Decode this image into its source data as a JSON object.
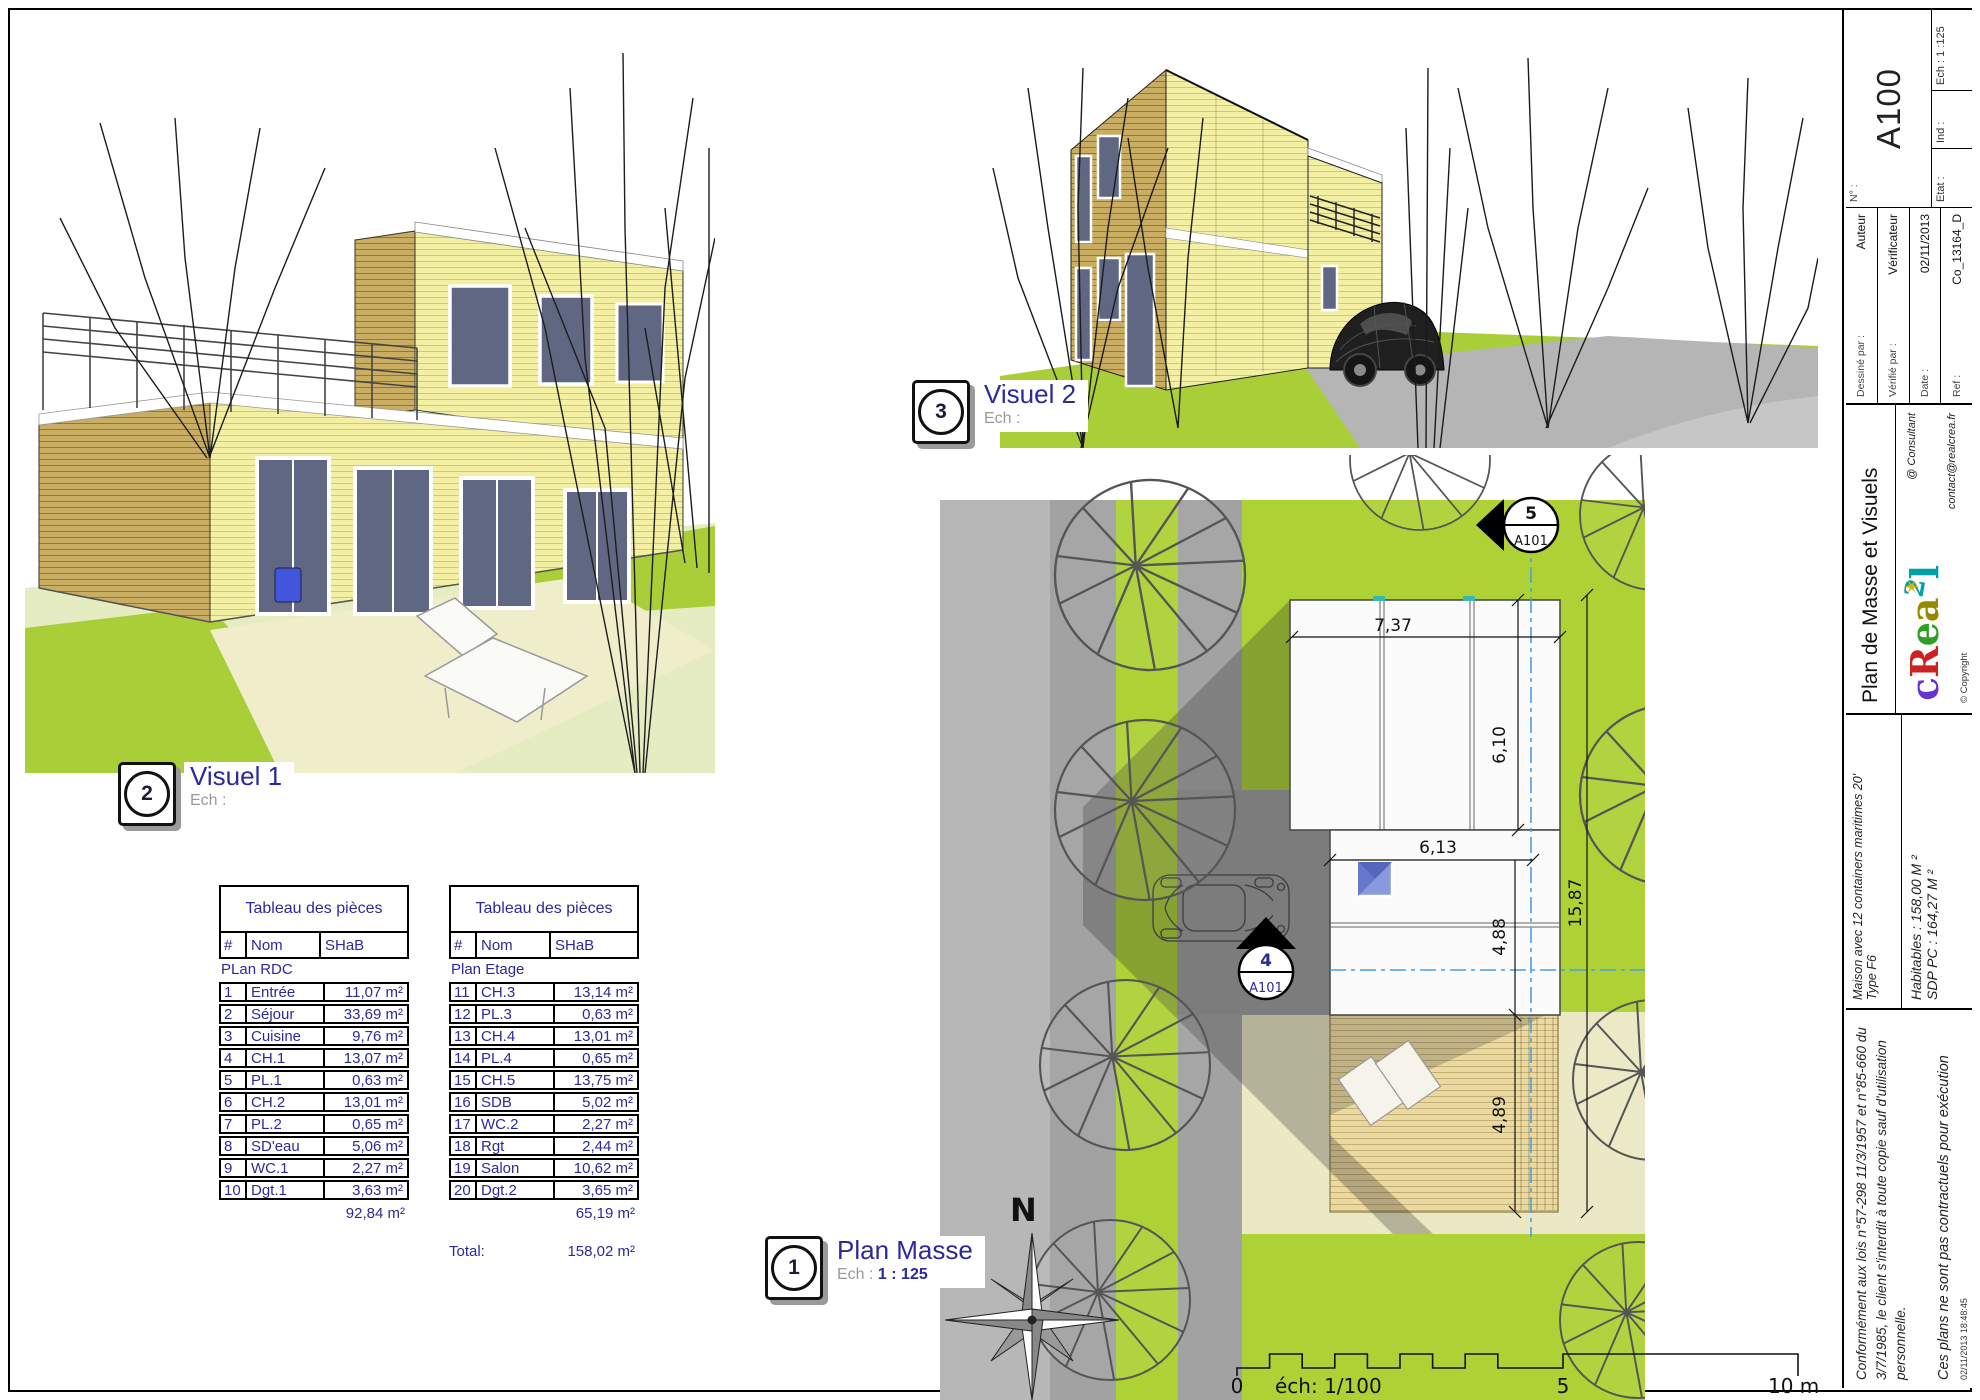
{
  "colors": {
    "lime": "#aed136",
    "navy": "#2a2a9a",
    "siding_tan": "#c8ad62",
    "siding_yellow": "#f3f0a3",
    "axis_blue": "#49a0e2",
    "teal_mark": "#39b8ac"
  },
  "visual1": {
    "badge": "2",
    "title": "Visuel 1",
    "scale_prefix": "Ech :",
    "scale_value": ""
  },
  "visual2": {
    "badge": "3",
    "title": "Visuel 2",
    "scale_prefix": "Ech :",
    "scale_value": ""
  },
  "plan": {
    "badge": "1",
    "title": "Plan Masse",
    "scale_prefix": "Ech :",
    "scale_value": "1 : 125",
    "north": "N",
    "marker_top": {
      "num": "5",
      "ref": "A101"
    },
    "marker_left": {
      "num": "4",
      "ref": "A101"
    },
    "dims": {
      "top": "7,37",
      "upper_right": "6,10",
      "middle": "6,13",
      "middle_right": "4,88",
      "overall": "15,87",
      "deck": "4,89"
    },
    "scalebar": {
      "zero": "0",
      "scale": "éch: 1/100",
      "five": "5",
      "ten": "10 m"
    }
  },
  "tables": {
    "rdc": {
      "title": "Tableau des pièces",
      "num": "#",
      "name": "Nom",
      "area": "SHaB",
      "section": "PLan RDC",
      "rows": [
        [
          "1",
          "Entrée",
          "11,07 m²"
        ],
        [
          "2",
          "Séjour",
          "33,69 m²"
        ],
        [
          "3",
          "Cuisine",
          "9,76 m²"
        ],
        [
          "4",
          "CH.1",
          "13,07 m²"
        ],
        [
          "5",
          "PL.1",
          "0,63 m²"
        ],
        [
          "6",
          "CH.2",
          "13,01 m²"
        ],
        [
          "7",
          "PL.2",
          "0,65 m²"
        ],
        [
          "8",
          "SD'eau",
          "5,06 m²"
        ],
        [
          "9",
          "WC.1",
          "2,27 m²"
        ],
        [
          "10",
          "Dgt.1",
          "3,63 m²"
        ]
      ],
      "subtotal": "92,84 m²"
    },
    "etage": {
      "title": "Tableau des pièces",
      "num": "#",
      "name": "Nom",
      "area": "SHaB",
      "section": "Plan Etage",
      "rows": [
        [
          "11",
          "CH.3",
          "13,14 m²"
        ],
        [
          "12",
          "PL.3",
          "0,63 m²"
        ],
        [
          "13",
          "CH.4",
          "13,01 m²"
        ],
        [
          "14",
          "PL.4",
          "0,65 m²"
        ],
        [
          "15",
          "CH.5",
          "13,75 m²"
        ],
        [
          "16",
          "SDB",
          "5,02 m²"
        ],
        [
          "17",
          "WC.2",
          "2,27 m²"
        ],
        [
          "18",
          "Rgt",
          "2,44 m²"
        ],
        [
          "19",
          "Salon",
          "10,62 m²"
        ],
        [
          "20",
          "Dgt.2",
          "3,65 m²"
        ]
      ],
      "subtotal": "65,19 m²"
    },
    "total_label": "Total:",
    "total_value": "158,02 m²"
  },
  "titleblock": {
    "legal": "Conformément aux lois n°57-298 11/3/1957 et n°85-660 du 3/7/1985, le client s'interdit à toute copie sauf d'utilisation personnelle.",
    "disclaimer": "Ces plans ne sont pas contractuels pour exécution",
    "timestamp": "02/11/2013 18:48:45",
    "project_line1": "Maison avec 12 containers maritimes 20'",
    "project_line2": "Type F6",
    "area_line1": "Habitables : 158,00 M ²",
    "area_line2": "SDP PC : 164,27 M ²",
    "sheet_title": "Plan de Masse et Visuels",
    "logo_letters": [
      "c",
      "R",
      "e",
      "a",
      "2",
      "l"
    ],
    "copyright": "© Copyright",
    "consultant": "@ Consultant",
    "email": "contact@realcrea.fr",
    "drawn_label": "Dessiné par :",
    "drawn_value": "Auteur",
    "checked_label": "Vérifié par :",
    "checked_value": "Vérificateur",
    "date_label": "Date :",
    "date_value": "02/11/2013",
    "ref_label": "Ref :",
    "ref_value": "Co_13164_D",
    "number_label": "N° :",
    "number_value": "A100",
    "scale_label": "Ech : 1 :125",
    "ind_label": "Ind :",
    "etat_label": "Etat :"
  }
}
